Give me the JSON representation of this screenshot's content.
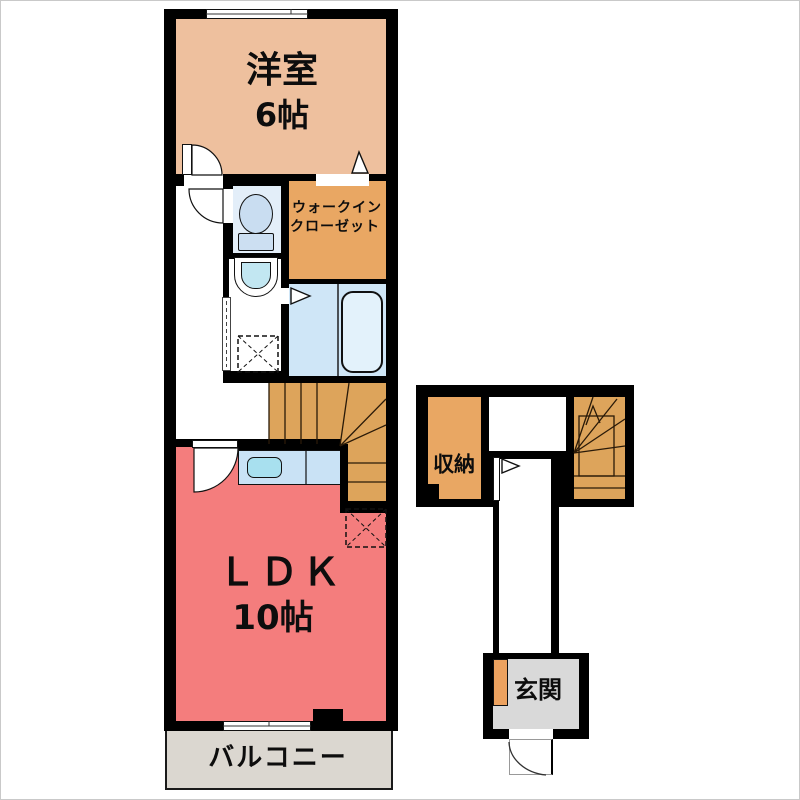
{
  "plan": {
    "rooms": {
      "bedroom": {
        "name": "洋室",
        "size": "6帖"
      },
      "walk_in_closet": {
        "name_line1": "ウォークイン",
        "name_line2": "クローゼット"
      },
      "ldk": {
        "name": "ＬＤＫ",
        "size": "10帖"
      },
      "balcony": {
        "name": "バルコニー"
      },
      "storage": {
        "name": "収納"
      },
      "entrance": {
        "name": "玄関"
      }
    },
    "colors": {
      "wall": "#000000",
      "bedroom_fill": "#eec09e",
      "closet_fill": "#e9a763",
      "stairs_fill": "#dda45b",
      "ldk_fill": "#f47d7d",
      "toilet_fill": "#e3eef9",
      "bathroom_fill": "#cfe6f7",
      "kitchen_counter_fill": "#c9e2f5",
      "balcony_fill": "#dbd7d0",
      "entrance_fill": "#d9d9d9",
      "shoe_cabinet_fill": "#eda25f"
    }
  }
}
